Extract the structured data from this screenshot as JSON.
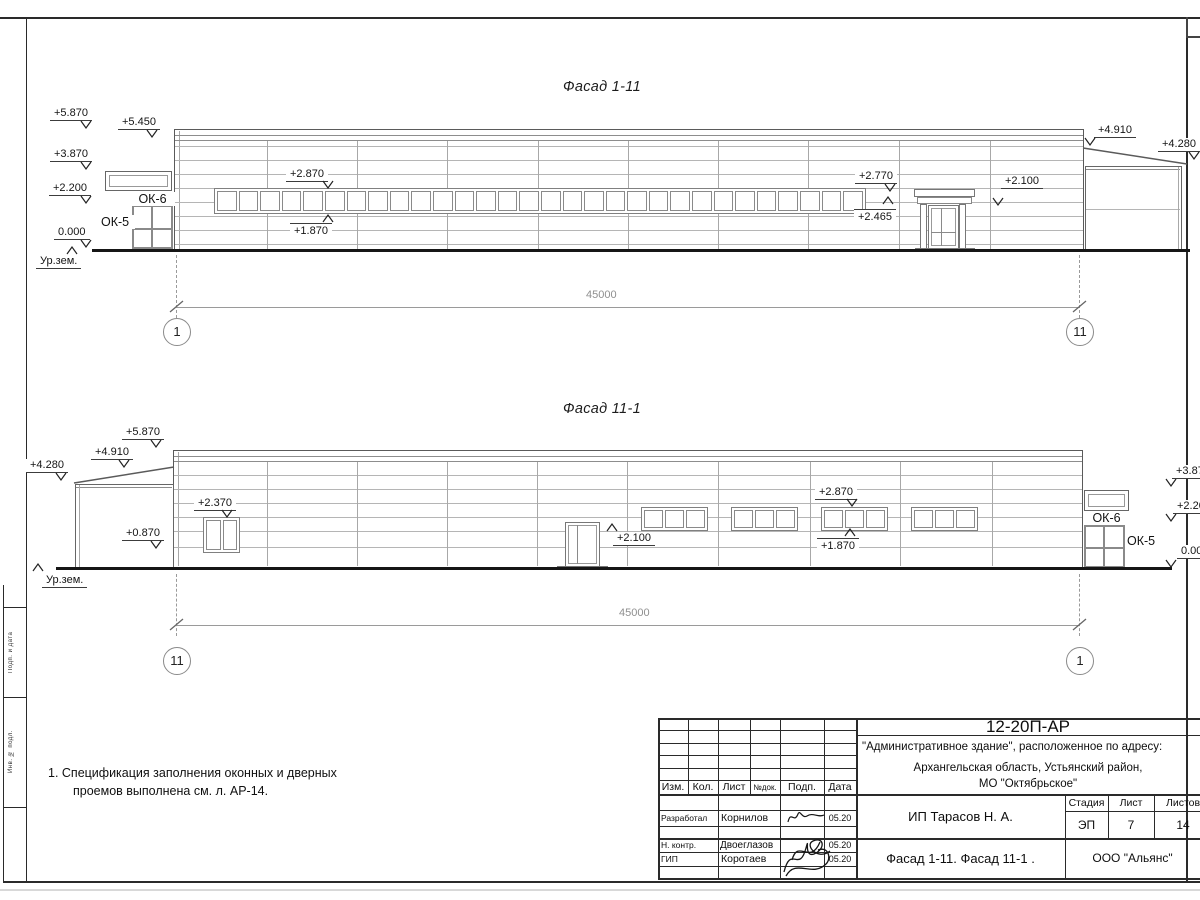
{
  "f1": {
    "title": "Фасад 1-11",
    "levels": [
      "+5.870",
      "+3.870",
      "+2.200",
      "0.000",
      "+5.450",
      "Ур.зем.",
      "+2.870",
      "+1.870",
      "+2.770",
      "+2.465",
      "+2.100",
      "+4.910",
      "+4.280"
    ],
    "ok": [
      "ОК-6",
      "ОК-5"
    ],
    "dim": "45000",
    "axes": [
      "1",
      "11"
    ]
  },
  "f2": {
    "title": "Фасад 11-1",
    "levels": [
      "+5.870",
      "+4.910",
      "+4.280",
      "+2.370",
      "+0.870",
      "Ур.зем.",
      "+2.100",
      "+2.870",
      "+1.870",
      "+3.870",
      "+2.200",
      "0.000"
    ],
    "ok": [
      "ОК-6",
      "ОК-5"
    ],
    "dim": "45000",
    "axes": [
      "11",
      "1"
    ]
  },
  "notes": {
    "line1": "1. Спецификация заполнения оконных и дверных",
    "line2": "проемов выполнена см. л. АР-14."
  },
  "titleblock": {
    "doc_code": "12-20П-АР",
    "project_line1": "\"Административное здание\", расположенное по адресу:",
    "project_line2": "Архангельская область, Устьянский район,",
    "project_line3": "МО \"Октябрьское\"",
    "client": "ИП Тарасов Н. А.",
    "sheet_title": "Фасад 1-11. Фасад 11-1 .",
    "company": "ООО \"Альянс\"",
    "headers": {
      "izm": "Изм.",
      "kol": "Кол.",
      "list": "Лист",
      "ndok": "№док.",
      "podp": "Подп.",
      "data": "Дата",
      "stage": "Стадия",
      "sheet": "Лист",
      "sheets": "Листов"
    },
    "stage": "ЭП",
    "sheet_no": "7",
    "sheet_count": "14",
    "rows": [
      {
        "role": "Разработал",
        "name": "Корнилов",
        "date": "05.20"
      },
      {
        "role": "Н. контр.",
        "name": "Двоеглазов",
        "date": "05.20"
      },
      {
        "role": "ГИП",
        "name": "Коротаев",
        "date": "05.20"
      }
    ]
  },
  "side_strip": {
    "label1": "Подп. и дата",
    "label2": "Инв. № подл."
  },
  "geometry": {
    "ribbon_panes": 30,
    "window3_panes": 3,
    "window2_panes": 2
  }
}
